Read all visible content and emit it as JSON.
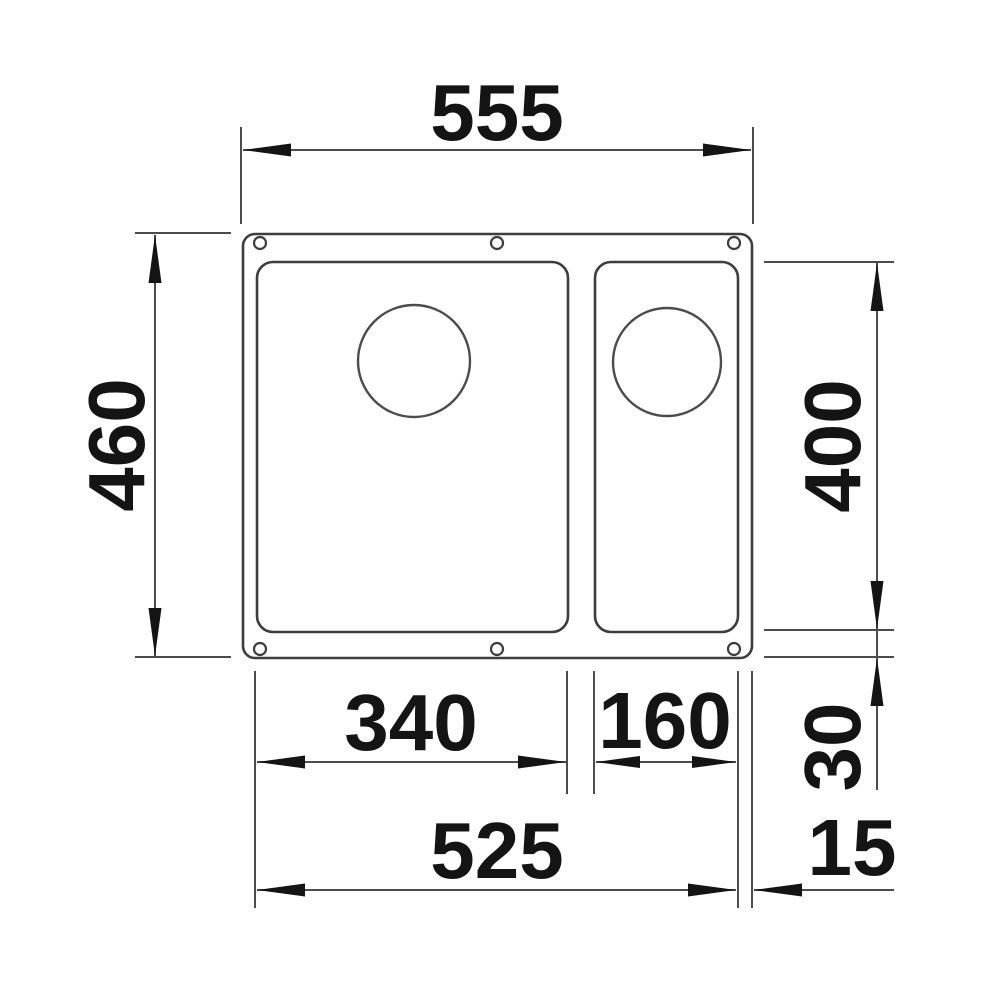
{
  "colors": {
    "line": "#4c4c4c",
    "ink": "#141414",
    "background": "#ffffff"
  },
  "drawing": {
    "dimensions": {
      "overall_width": "555",
      "overall_depth": "460",
      "bowls_depth": "400",
      "main_bowl_width": "340",
      "small_bowl_width": "160",
      "bowls_span_width": "525",
      "bottom_rim": "30",
      "right_rim": "15"
    }
  }
}
